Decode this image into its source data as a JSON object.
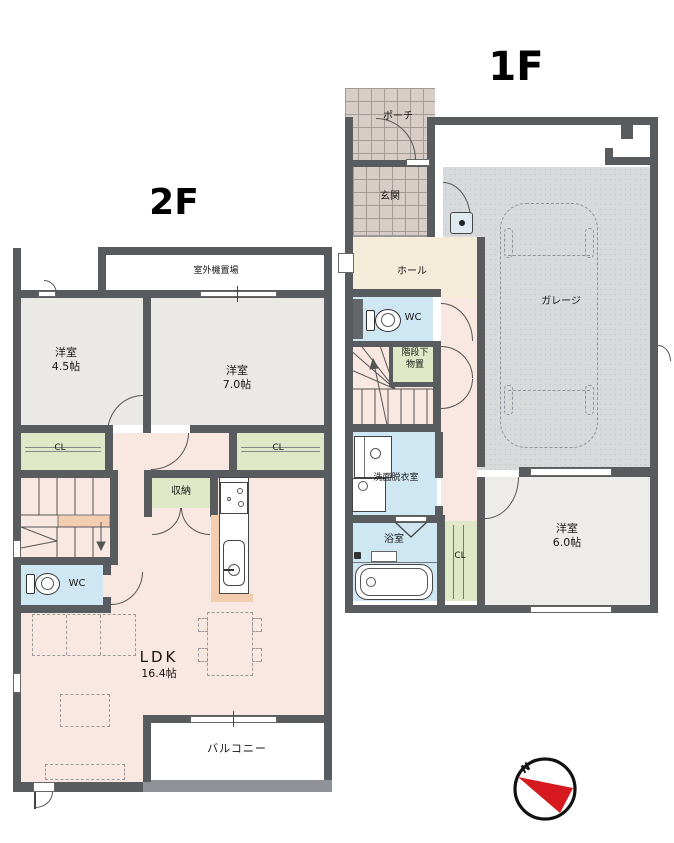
{
  "floor1": {
    "title": "1F",
    "porch": "ポーチ",
    "entrance": "玄関",
    "hall": "ホール",
    "wc": "WC",
    "understair_line1": "階段下",
    "understair_line2": "物置",
    "garage": "ガレージ",
    "washroom": "洗面脱衣室",
    "bathroom": "浴室",
    "closet": "CL",
    "bedroom_name": "洋室",
    "bedroom_size": "6.0帖"
  },
  "floor2": {
    "title": "2F",
    "outdoor_unit": "室外機置場",
    "bedroom1_name": "洋室",
    "bedroom1_size": "4.5帖",
    "bedroom2_name": "洋室",
    "bedroom2_size": "7.0帖",
    "closet_left": "CL",
    "closet_right": "CL",
    "storage": "収納",
    "wc": "WC",
    "ldk_name": "LDK",
    "ldk_size": "16.4帖",
    "balcony": "バルコニー"
  },
  "compass": {
    "north": "N"
  },
  "colors": {
    "wall": "#595c5f",
    "room_gray": "#ebe9e6",
    "ldk_pink": "#f9e7e1",
    "hall_cream": "#f4ebd8",
    "wet_blue": "#cfe7f3",
    "closet_green": "#dfe8c6",
    "tile": "#d8ccc7",
    "garage": "#d7d9db",
    "counter_peach": "#f2cdb0",
    "compass_red": "#d6191f"
  }
}
